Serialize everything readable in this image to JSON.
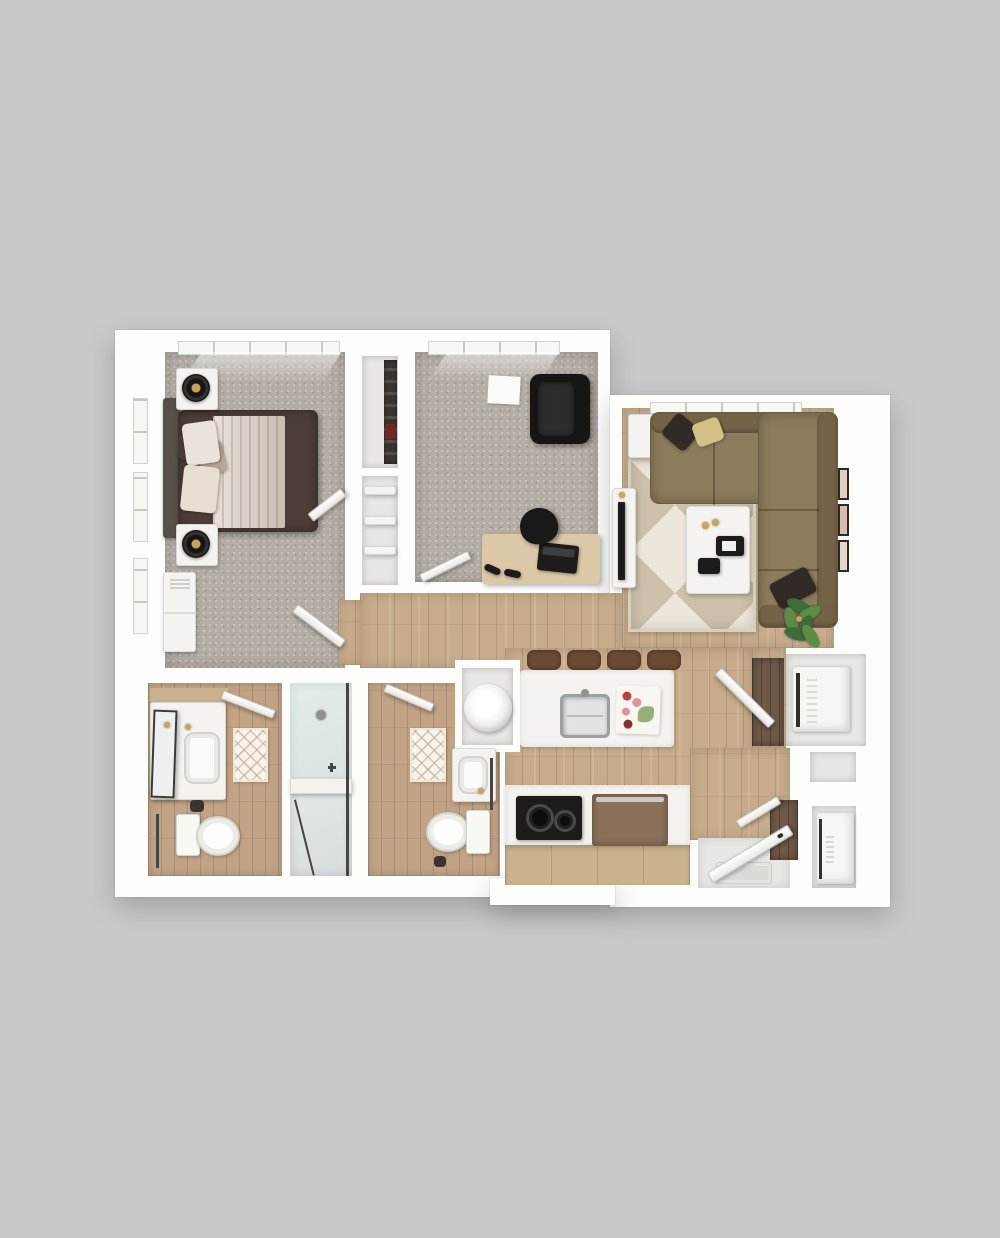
{
  "scene": {
    "type": "3d-floor-plan-render",
    "view": "top-down",
    "description": "Two-bath one-bedroom-plus-den apartment floor plan rendered in 3D on a gray background, no text labels"
  },
  "colors": {
    "bg": "#c9c9c9",
    "wall": "#fdfdfc",
    "carpet": "#b4ada5",
    "wood": "#c7ac8b",
    "bath-wood": "#c2a385",
    "dark-wood": "#6e5846",
    "tile": "#e9e7e3",
    "closet-int": "#e9e7e3",
    "rug-base": "#ece6da",
    "rug-alt": "#ccc0aa",
    "sofa": "#8d7c5c",
    "sofa-dark": "#746347",
    "pillow-dark": "#312a26",
    "pillow-cream": "#d3c086",
    "bed-dark": "#4c3e37",
    "duvet": "#d9cfc2",
    "headboard": "#565049",
    "furn-white": "#f4f3f0",
    "ink": "#1d1c1b",
    "gold": "#c8a35b",
    "counter": "#f3f2ee",
    "cabinet": "#c9b28d",
    "steel": "#aeb2b2",
    "glass-frame": "#454543",
    "frame-dark": "#454543",
    "green-a": "#3f6d38",
    "green-b": "#5d8c4a",
    "stool": "#6b4a33",
    "appliance": "#f6f6f3",
    "appliance-brown": "#8a7058",
    "desk-wood": "#dcc8a6",
    "food-red": "#b8413f",
    "food-pink": "#e0939b",
    "food-green": "#7f9e5f"
  },
  "rooms": [
    {
      "id": "bedroom",
      "furniture": [
        "bed",
        "headboard",
        "pillows",
        "nightstand-left",
        "nightstand-right",
        "table-lamps",
        "dresser",
        "wall-closet"
      ]
    },
    {
      "id": "den-office",
      "furniture": [
        "desk",
        "laptop",
        "desk-chair",
        "lounge-chair",
        "floor-paper",
        "dumbbells"
      ]
    },
    {
      "id": "living-room",
      "furniture": [
        "sectional-sofa",
        "throw-pillows",
        "coffee-table",
        "side-table",
        "tv-console",
        "tv",
        "area-rug",
        "potted-plant",
        "wall-art-frames"
      ]
    },
    {
      "id": "kitchen",
      "furniture": [
        "island",
        "island-sink",
        "cutting-board",
        "bar-stools",
        "cooktop",
        "range",
        "base-cabinets"
      ]
    },
    {
      "id": "bathroom-1",
      "furniture": [
        "vanity",
        "mirror",
        "sink",
        "toilet",
        "bath-mat",
        "towel-bar",
        "walk-in-shower"
      ]
    },
    {
      "id": "bathroom-2",
      "furniture": [
        "vanity",
        "sink",
        "toilet",
        "bath-mat",
        "towel-bar",
        "washer-niche"
      ]
    },
    {
      "id": "laundry-closet",
      "furniture": [
        "washer"
      ]
    },
    {
      "id": "entry",
      "furniture": [
        "entry-door",
        "door-mat",
        "coat-closet",
        "utility-closet",
        "water-heater"
      ]
    },
    {
      "id": "hall-closets",
      "furniture": [
        "hanging-clothes",
        "shelves"
      ]
    }
  ]
}
